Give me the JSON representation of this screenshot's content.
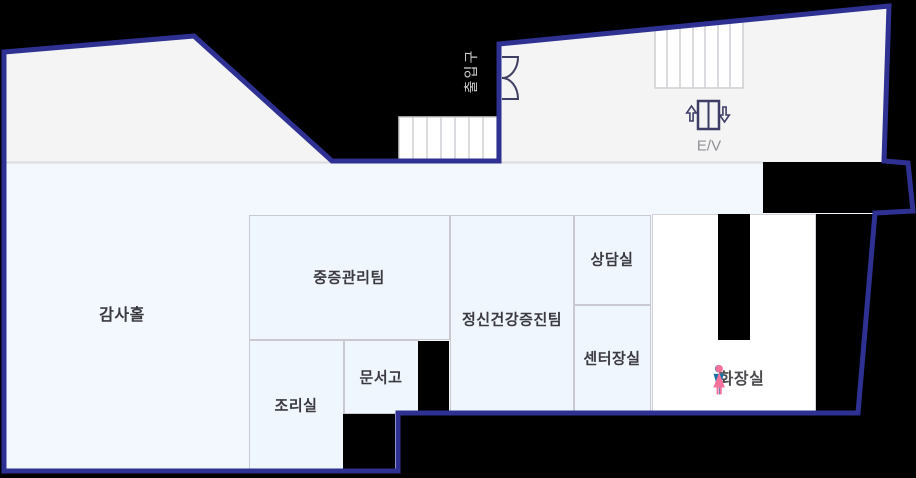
{
  "rooms": {
    "gamsa_hall": {
      "label": "감사홀"
    },
    "severe_mgmt_team": {
      "label": "중증관리팀"
    },
    "mental_health_team": {
      "label": "정신건강증진팀"
    },
    "counseling_room": {
      "label": "상담실"
    },
    "director_office": {
      "label": "센터장실"
    },
    "kitchen": {
      "label": "조리실"
    },
    "document_storage": {
      "label": "문서고"
    },
    "restroom": {
      "label": "화장실"
    }
  },
  "facilities": {
    "entrance_label": "출입구",
    "elevator_label": "E/V"
  },
  "icons": {
    "stairs_upper_right": "stairs-icon",
    "stairs_center": "stairs-icon",
    "elevator": "elevator-doors-icon",
    "entrance_door": "double-swing-door-icon",
    "restroom_male": "male-figure-icon",
    "restroom_female": "female-figure-icon"
  },
  "colors": {
    "outline_navy": "#2e3192",
    "floor_light_blue": "#f2f8fd",
    "room_fill": "#eff6fd",
    "gray_zone": "#f4f4f4",
    "background_black": "#000000",
    "divider_gray": "#c9c9d2",
    "male_icon_blue": "#1470a8",
    "female_icon_pink": "#f4719c",
    "label_text": "#3a3a40",
    "elevator_text_gray": "#8f8f97"
  }
}
